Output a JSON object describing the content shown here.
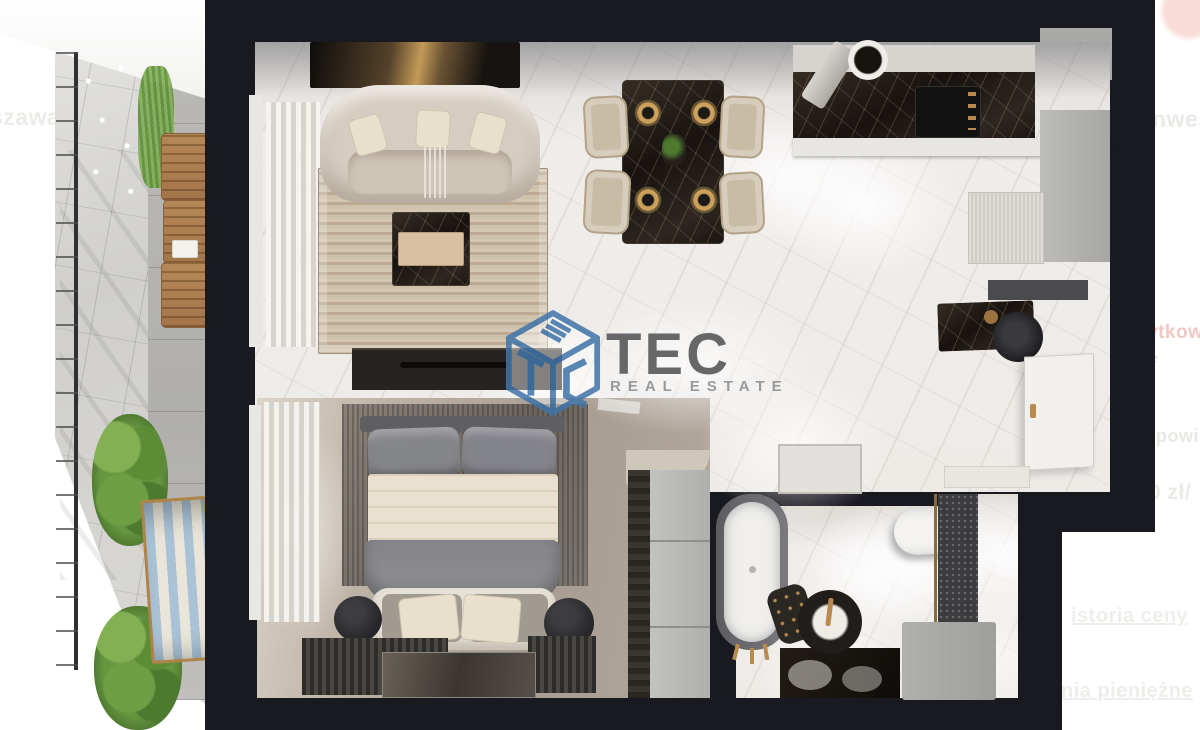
{
  "page": {
    "background": "#ffffff",
    "fragments": {
      "top_left_logo": "A.DOM",
      "left_city": "szawa",
      "right_invest": "nwes",
      "right_area_label": "ytkowy",
      "right_small": "e",
      "right_area": "² powi",
      "right_price": "0 zł/",
      "link_price_history": "istoria ceny",
      "link_money": "nia pieniężne"
    }
  },
  "watermark": {
    "brand": "TEC",
    "tagline": "REAL ESTATE",
    "cube_color": "#3f74a9",
    "brand_color": "#58585a",
    "tagline_color": "#909092"
  },
  "colors": {
    "wall": "#191920",
    "marble_floor": "#edebe7",
    "bedroom_carpet": "#b3a89d",
    "brass_accent": "#b98a4e",
    "rug_beige": "#c9bba3",
    "plant_green": "#679640",
    "deckchair_blue": "#a9c2d5",
    "logo_pink": "#f0b6b1"
  }
}
